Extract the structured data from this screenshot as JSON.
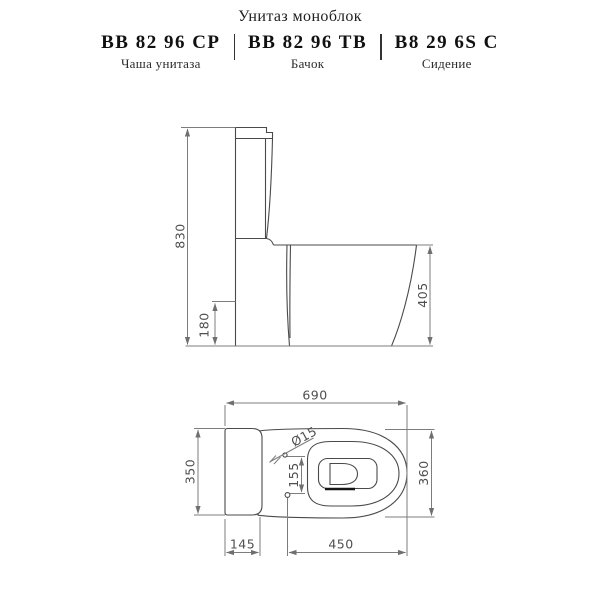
{
  "header": {
    "title": "Унитаз моноблок",
    "products": [
      {
        "code": "BB 82 96 CP",
        "label": "Чаша унитаза"
      },
      {
        "code": "BB 82 96 TB",
        "label": "Бачок"
      },
      {
        "code": "B8 29 6S C",
        "label": "Сидение"
      }
    ]
  },
  "side_view": {
    "name": "боковой вид",
    "dims": {
      "height_total": "830",
      "inlet_height": "180",
      "bowl_height": "405"
    }
  },
  "top_view": {
    "name": "вид сверху",
    "dims": {
      "width_total": "690",
      "tank_width": "350",
      "bowl_width": "360",
      "tank_depth": "145",
      "bowl_depth": "450",
      "hole_spacing": "155",
      "hole_diameter": "Ø15"
    }
  },
  "colors": {
    "outline": "#4a4a4a",
    "dimension_line": "#7d7d7d",
    "dimension_text": "#4f4f4f",
    "header_text": "#111111"
  }
}
